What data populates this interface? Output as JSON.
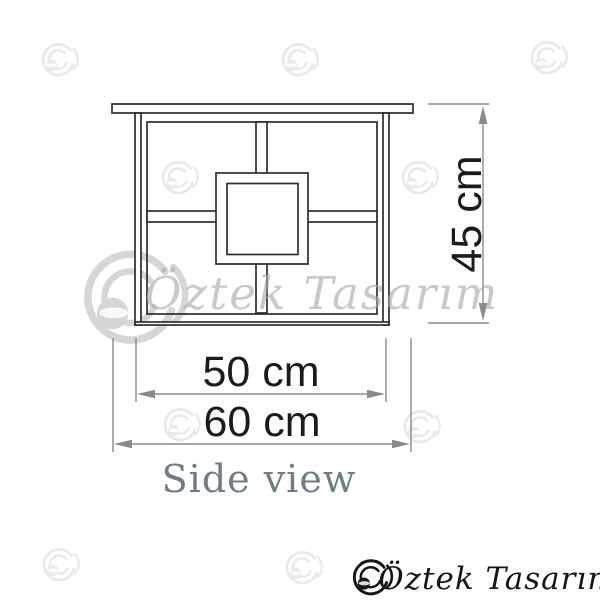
{
  "diagram": {
    "view_label": "Side view",
    "dimensions": {
      "height": "45 cm",
      "shelf_width": "50 cm",
      "total_width": "60 cm"
    }
  },
  "watermark": {
    "brand_script": "Öztek Tasarım"
  },
  "logo": {
    "brand": "Öztek Tasarım"
  },
  "colors": {
    "outline": "#2d2d2d",
    "dimension": "#8a8a8a",
    "dimension_text": "#1b1b1b",
    "view_label": "#6f7d84",
    "watermark": "#e9e9e9",
    "watermark_big": "#d6d6d6",
    "watermark_text": "#a9a9a9",
    "logo_color": "#161616"
  }
}
